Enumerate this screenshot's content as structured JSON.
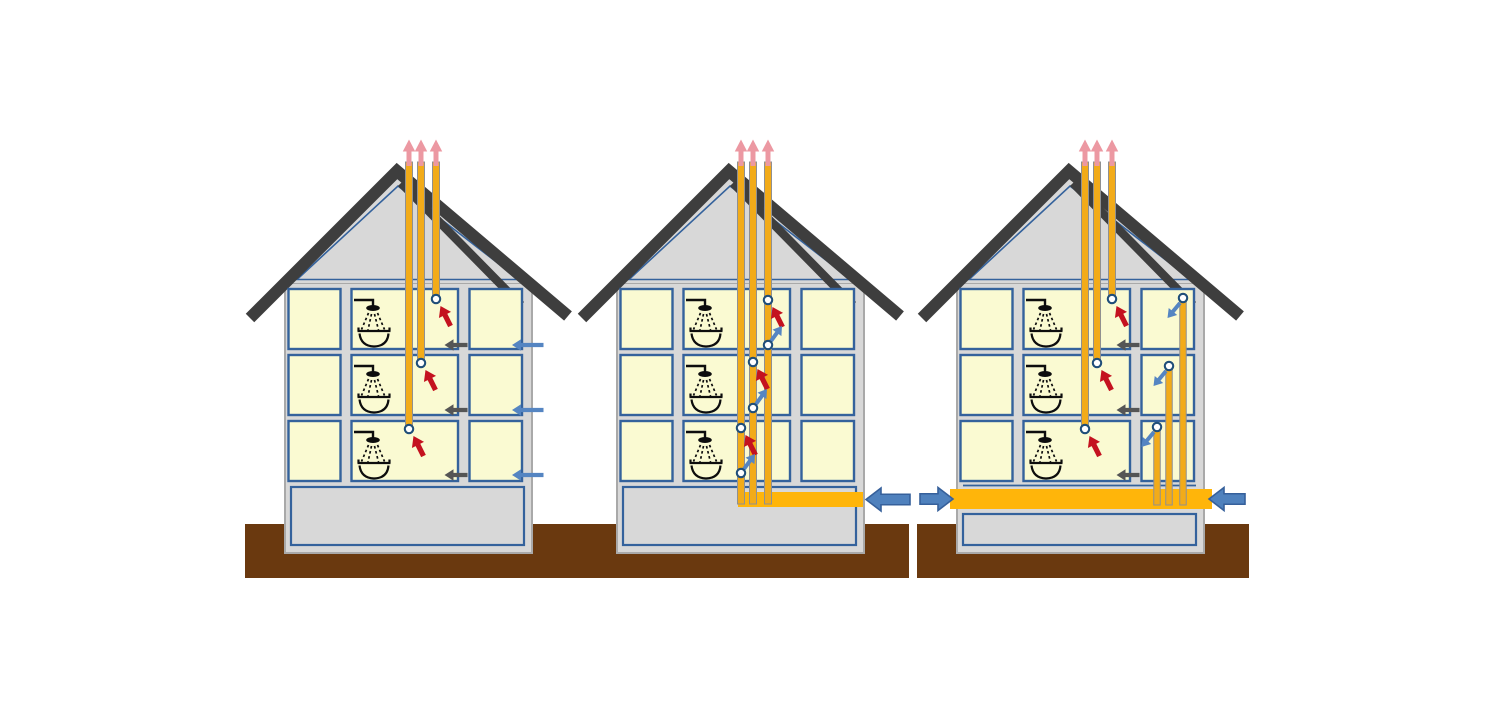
{
  "diagram": {
    "background": "#ffffff",
    "canvas": {
      "width": 1495,
      "height": 712
    },
    "colors": {
      "wall": "#d8d8d8",
      "wall_stroke": "#a9a9a9",
      "room_fill": "#fafad2",
      "room_stroke": "#34629c",
      "roof": "#3e3e3e",
      "ground": "#6a390f",
      "pipe": "#f2ab19",
      "pipe_stroke": "#909090",
      "duct": "#ffb50a",
      "pink": "#ec98a2",
      "red": "#c4121f",
      "steel_blue": "#4f81bd",
      "steel_blue_dark": "#36609b",
      "small_blue": "#5585c2",
      "gray_arrow": "#555555",
      "circle_ring": "#1f4e79",
      "circle_fill": "#ffffff",
      "ink": "#0d0d0d"
    },
    "base": {
      "ground": [
        245,
        524,
        332,
        54
      ],
      "body": [
        285,
        283,
        247,
        270
      ],
      "attic": [
        [
          288,
          283
        ],
        [
          529,
          283
        ],
        [
          398,
          177
        ]
      ],
      "attic_inset": [
        [
          297,
          279.5
        ],
        [
          519,
          279.5
        ],
        [
          398,
          186
        ]
      ],
      "roof_near": [
        [
          250,
          318
        ],
        [
          397,
          171
        ],
        [
          568,
          316
        ]
      ],
      "roof_near_width": 12,
      "roof_far": [
        [
          401,
          183
        ],
        [
          521,
          305
        ]
      ],
      "roof_far_width": 8.5,
      "room_cols": [
        [
          288.5,
          52
        ],
        [
          351.5,
          106.5
        ],
        [
          469.5,
          52.5
        ]
      ],
      "room_rows": [
        [
          289,
          60
        ],
        [
          355,
          60
        ],
        [
          421,
          60
        ]
      ],
      "basement": [
        291,
        487,
        233,
        58
      ],
      "pink_arrow": {
        "tip_y": 139.5,
        "base_y": 166
      },
      "transfer_arrow": {
        "tip_x": 444.5,
        "tail_x": 467.5
      },
      "inlet_arrow": {
        "tip_x": 512,
        "tail_x": 543.5
      }
    },
    "houses": [
      {
        "id": "house-1-individual-exhaust-ducts",
        "dx": 0,
        "pipes": [
          {
            "x": 436,
            "y1": 162,
            "y2": 295
          },
          {
            "x": 421,
            "y1": 162,
            "y2": 359
          },
          {
            "x": 409,
            "y1": 162,
            "y2": 425
          }
        ],
        "pink": [
          409,
          421,
          436
        ],
        "outlets": [
          {
            "cx": 436,
            "cy": 299,
            "kind": "extract"
          },
          {
            "cx": 421,
            "cy": 363,
            "kind": "extract"
          },
          {
            "cx": 409,
            "cy": 429,
            "kind": "extract"
          }
        ],
        "transfer_arrows_y": [
          345,
          410,
          475
        ],
        "inlet_arrows_y": [
          345,
          410,
          475
        ]
      },
      {
        "id": "house-2-shared-shaft-bottom-intake",
        "dx": 332,
        "ducts": [
          [
            406,
            492,
            125,
            15
          ]
        ],
        "pipes": [
          {
            "x": 436,
            "y1": 162,
            "y2": 504
          },
          {
            "x": 421,
            "y1": 162,
            "y2": 504
          },
          {
            "x": 409,
            "y1": 162,
            "y2": 504
          }
        ],
        "pink": [
          409,
          421,
          436
        ],
        "outlets": [
          {
            "cx": 436,
            "cy": 300,
            "kind": "extract"
          },
          {
            "cx": 421,
            "cy": 362,
            "kind": "extract"
          },
          {
            "cx": 409,
            "cy": 428,
            "kind": "extract"
          },
          {
            "cx": 436,
            "cy": 345,
            "kind": "shaft-up"
          },
          {
            "cx": 421,
            "cy": 408,
            "kind": "shaft-up"
          },
          {
            "cx": 409,
            "cy": 473,
            "kind": "shaft-up"
          }
        ],
        "big_arrows": [
          {
            "tip": [
              534,
              499.5
            ],
            "tail": [
              578,
              499.5
            ]
          }
        ]
      },
      {
        "id": "house-3-central-supply-duct",
        "dx": 672,
        "ducts": [
          [
            278,
            489,
            262,
            20
          ]
        ],
        "slab_line": [
          291,
          485.5,
          524
        ],
        "basement": [
          291,
          514,
          233,
          31
        ],
        "pipes": [
          {
            "x": 440,
            "y1": 162,
            "y2": 295
          },
          {
            "x": 425,
            "y1": 162,
            "y2": 359
          },
          {
            "x": 413,
            "y1": 162,
            "y2": 425
          }
        ],
        "risers": [
          {
            "x": 511,
            "y1": 300,
            "y2": 505
          },
          {
            "x": 497,
            "y1": 368,
            "y2": 505
          },
          {
            "x": 485,
            "y1": 429,
            "y2": 505
          }
        ],
        "pink": [
          413,
          425,
          440
        ],
        "outlets": [
          {
            "cx": 440,
            "cy": 299,
            "kind": "extract"
          },
          {
            "cx": 425,
            "cy": 363,
            "kind": "extract"
          },
          {
            "cx": 413,
            "cy": 429,
            "kind": "extract"
          },
          {
            "cx": 511,
            "cy": 298,
            "kind": "supply-down"
          },
          {
            "cx": 497,
            "cy": 366,
            "kind": "supply-down"
          },
          {
            "cx": 485,
            "cy": 427,
            "kind": "supply-down"
          }
        ],
        "transfer_arrows_y": [
          345,
          410,
          475
        ],
        "big_arrows": [
          {
            "tip": [
              281,
              499
            ],
            "tail": [
              248,
              499
            ]
          },
          {
            "tip": [
              537,
              499
            ],
            "tail": [
              573,
              499
            ]
          }
        ]
      }
    ]
  }
}
